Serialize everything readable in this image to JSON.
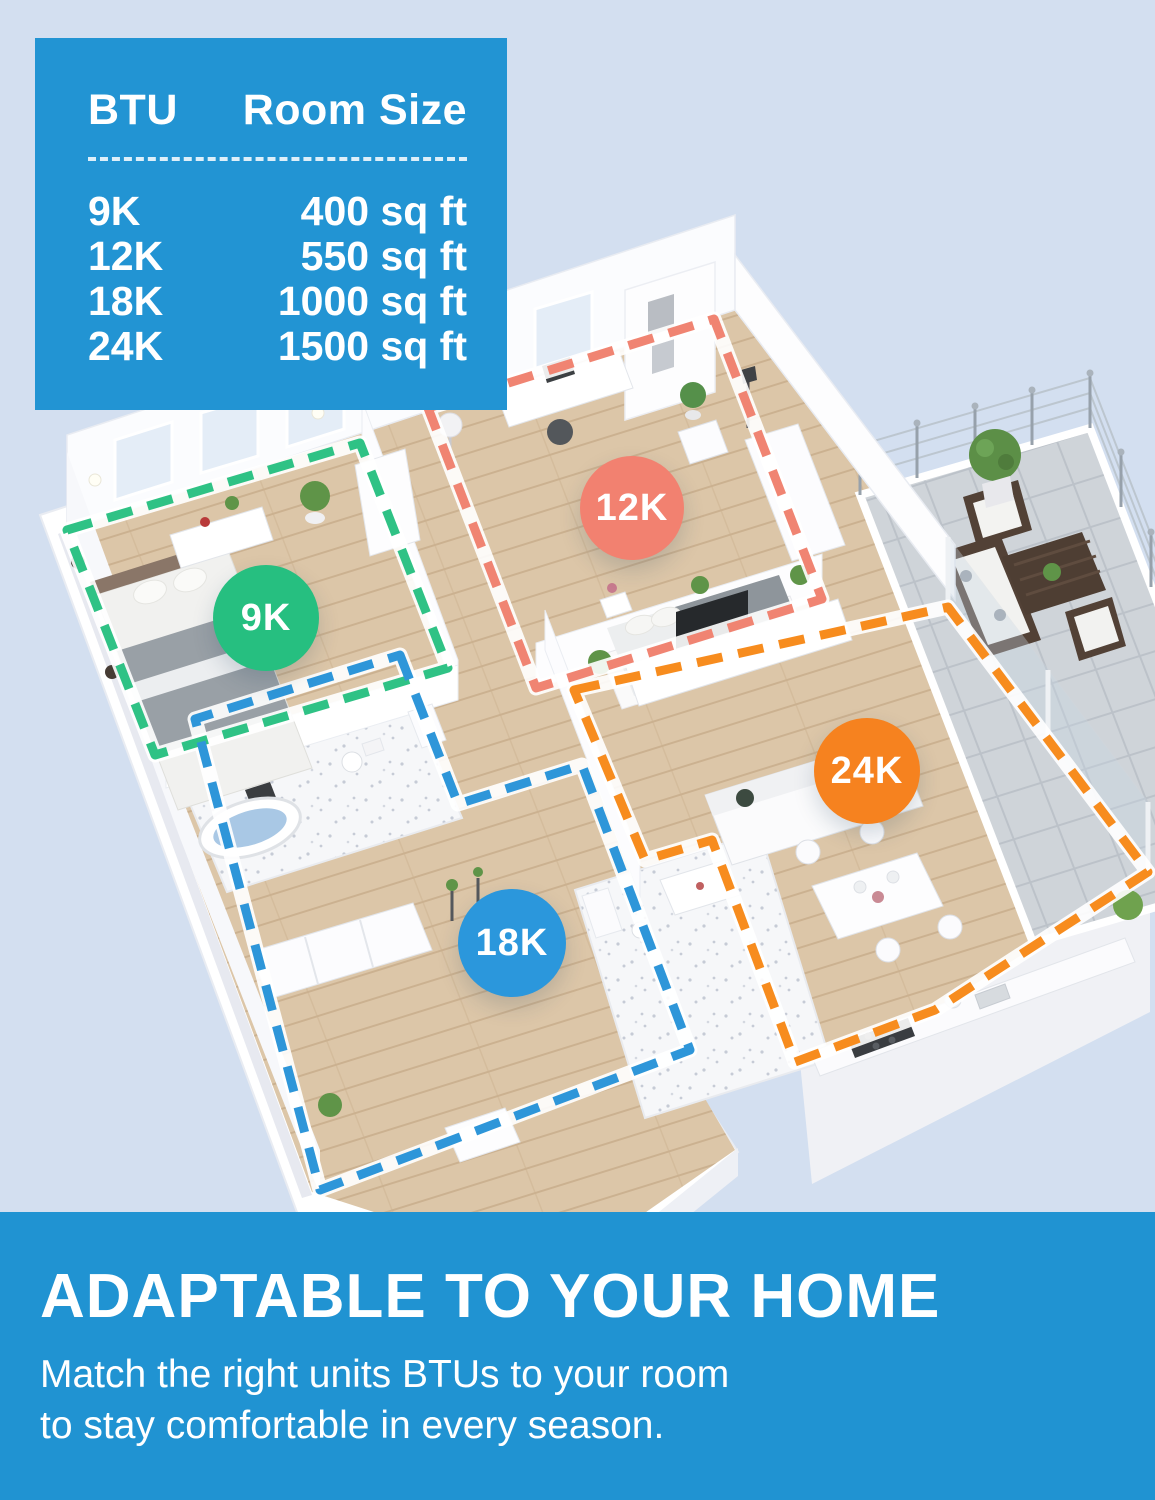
{
  "btu_table": {
    "col_btu": "BTU",
    "col_room": "Room Size",
    "rows": [
      {
        "btu": "9K",
        "room": "400 sq ft"
      },
      {
        "btu": "12K",
        "room": "550 sq ft"
      },
      {
        "btu": "18K",
        "room": "1000 sq ft"
      },
      {
        "btu": "24K",
        "room": "1500 sq ft"
      }
    ]
  },
  "floorplan": {
    "description": "3D isometric apartment floor plan with rooms outlined by BTU zone",
    "zones": [
      {
        "label": "9K",
        "color": "#26bf80"
      },
      {
        "label": "12K",
        "color": "#f28170"
      },
      {
        "label": "18K",
        "color": "#2b97dc"
      },
      {
        "label": "24K",
        "color": "#f6821f"
      }
    ]
  },
  "banner": {
    "heading": "ADAPTABLE TO YOUR HOME",
    "line1": "Match the right units BTUs to your room",
    "line2": "to stay comfortable in every season."
  },
  "colors": {
    "page_background": "#d3dff0",
    "accent_blue": "#2093d2",
    "zone_green": "#26bf80",
    "zone_salmon": "#f28170",
    "zone_blue": "#2b97dc",
    "zone_orange": "#f6821f"
  }
}
